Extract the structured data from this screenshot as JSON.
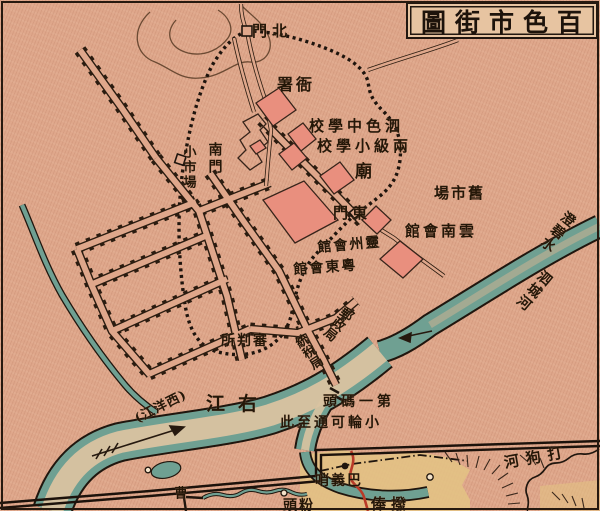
{
  "title": {
    "text": "圖街市色百"
  },
  "colors": {
    "paper": "#dfa78b",
    "river_teal": "#6fa092",
    "river_center": "#d9c3a1",
    "building_pink": "#e98f7e",
    "inset_yellow": "#e3c184",
    "road_red": "#b93a28",
    "ink": "#2b1c10"
  },
  "labels": {
    "north_gate": {
      "text": "門北"
    },
    "yamen": {
      "text": "署衙"
    },
    "sise_school": {
      "text": "校學中色泗"
    },
    "liangji_school": {
      "text": "校學小級兩"
    },
    "temple": {
      "text": "廟"
    },
    "south_gate": {
      "text": "南門"
    },
    "small_market": {
      "text": "小市場"
    },
    "east_gate": {
      "text": "門東"
    },
    "old_market": {
      "text": "場市舊"
    },
    "yunnan_hall": {
      "text": "館會南雲"
    },
    "lingzhou_hall": {
      "text": "館會州靈"
    },
    "yuedong_hall": {
      "text": "館會東粵"
    },
    "court": {
      "text": "所判審"
    },
    "post_office": {
      "text": "郵政局"
    },
    "tax_office": {
      "text": "統稅局"
    },
    "chengbi_water": {
      "text": "澄碧水"
    },
    "sicheng_river": {
      "text": "泗城河"
    },
    "dagou_river": {
      "text": "河狗打"
    },
    "you_river": {
      "text": "江右"
    },
    "xiyang_river": {
      "text": "(江洋西)"
    },
    "first_wharf": {
      "text": "頭碼一第"
    },
    "steamer_note": {
      "text": "此至通可輪小"
    },
    "bayi_post": {
      "text": "哨義巴"
    },
    "partial_right": {
      "text": "俸撥"
    },
    "partial_center": {
      "text": "頭粉"
    },
    "cao": {
      "text": "曹"
    }
  }
}
